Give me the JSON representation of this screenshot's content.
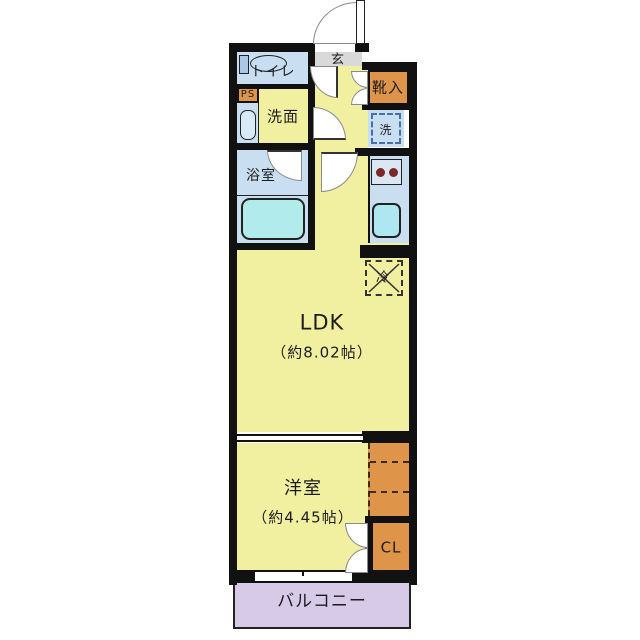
{
  "rooms": {
    "entrance": {
      "label": "玄"
    },
    "toilet": {
      "label": "トイレ"
    },
    "pipe_space": {
      "label": "PS"
    },
    "washroom": {
      "label": "洗面"
    },
    "bathroom": {
      "label": "浴室"
    },
    "shoe_cabinet": {
      "label": "靴入"
    },
    "washer": {
      "label": "洗"
    },
    "refrigerator": {
      "label": "冷"
    },
    "ldk": {
      "label": "LDK",
      "size": "（約8.02帖）"
    },
    "western_room": {
      "label": "洋室",
      "size": "（約4.45帖）"
    },
    "closet": {
      "label": "CL"
    },
    "balcony": {
      "label": "バルコニー"
    }
  },
  "colors": {
    "room_yellow": "#f1efa0",
    "wet_blue": "#c9def1",
    "fixture_cyan": "#b2ebeb",
    "sink_cyan": "#aee7ef",
    "storage_orange": "#de9549",
    "entrance_gray": "#d9d9d9",
    "balcony_purple": "#d7cae9",
    "wall": "#111111",
    "text": "#1c1c1c",
    "burner_red": "#7a2828",
    "basin_blue": "#d8e9f7",
    "tank_blue": "#a9c7e6",
    "bowl_blue": "#c7ddf2",
    "stove_blue": "#dbe8f4"
  },
  "icons": {
    "toilet-icon": "tank-rect + bowl-ellipse",
    "washbasin-icon": "rounded-rect",
    "bathtub-icon": "rounded-rect",
    "stove-burners-icon": "two-circles",
    "kitchen-sink-icon": "rounded-rect",
    "washer-pan-icon": "dashed-square",
    "fridge-space-icon": "dashed-square-with-x",
    "door-swing-icon": "quarter-circle",
    "folding-door-icon": "stacked-quarter-circles",
    "entrance-door-icon": "quarter-circle-with-leaf",
    "sliding-window-icon": "double-line-band",
    "sliding-partition-icon": "double-line-band"
  }
}
